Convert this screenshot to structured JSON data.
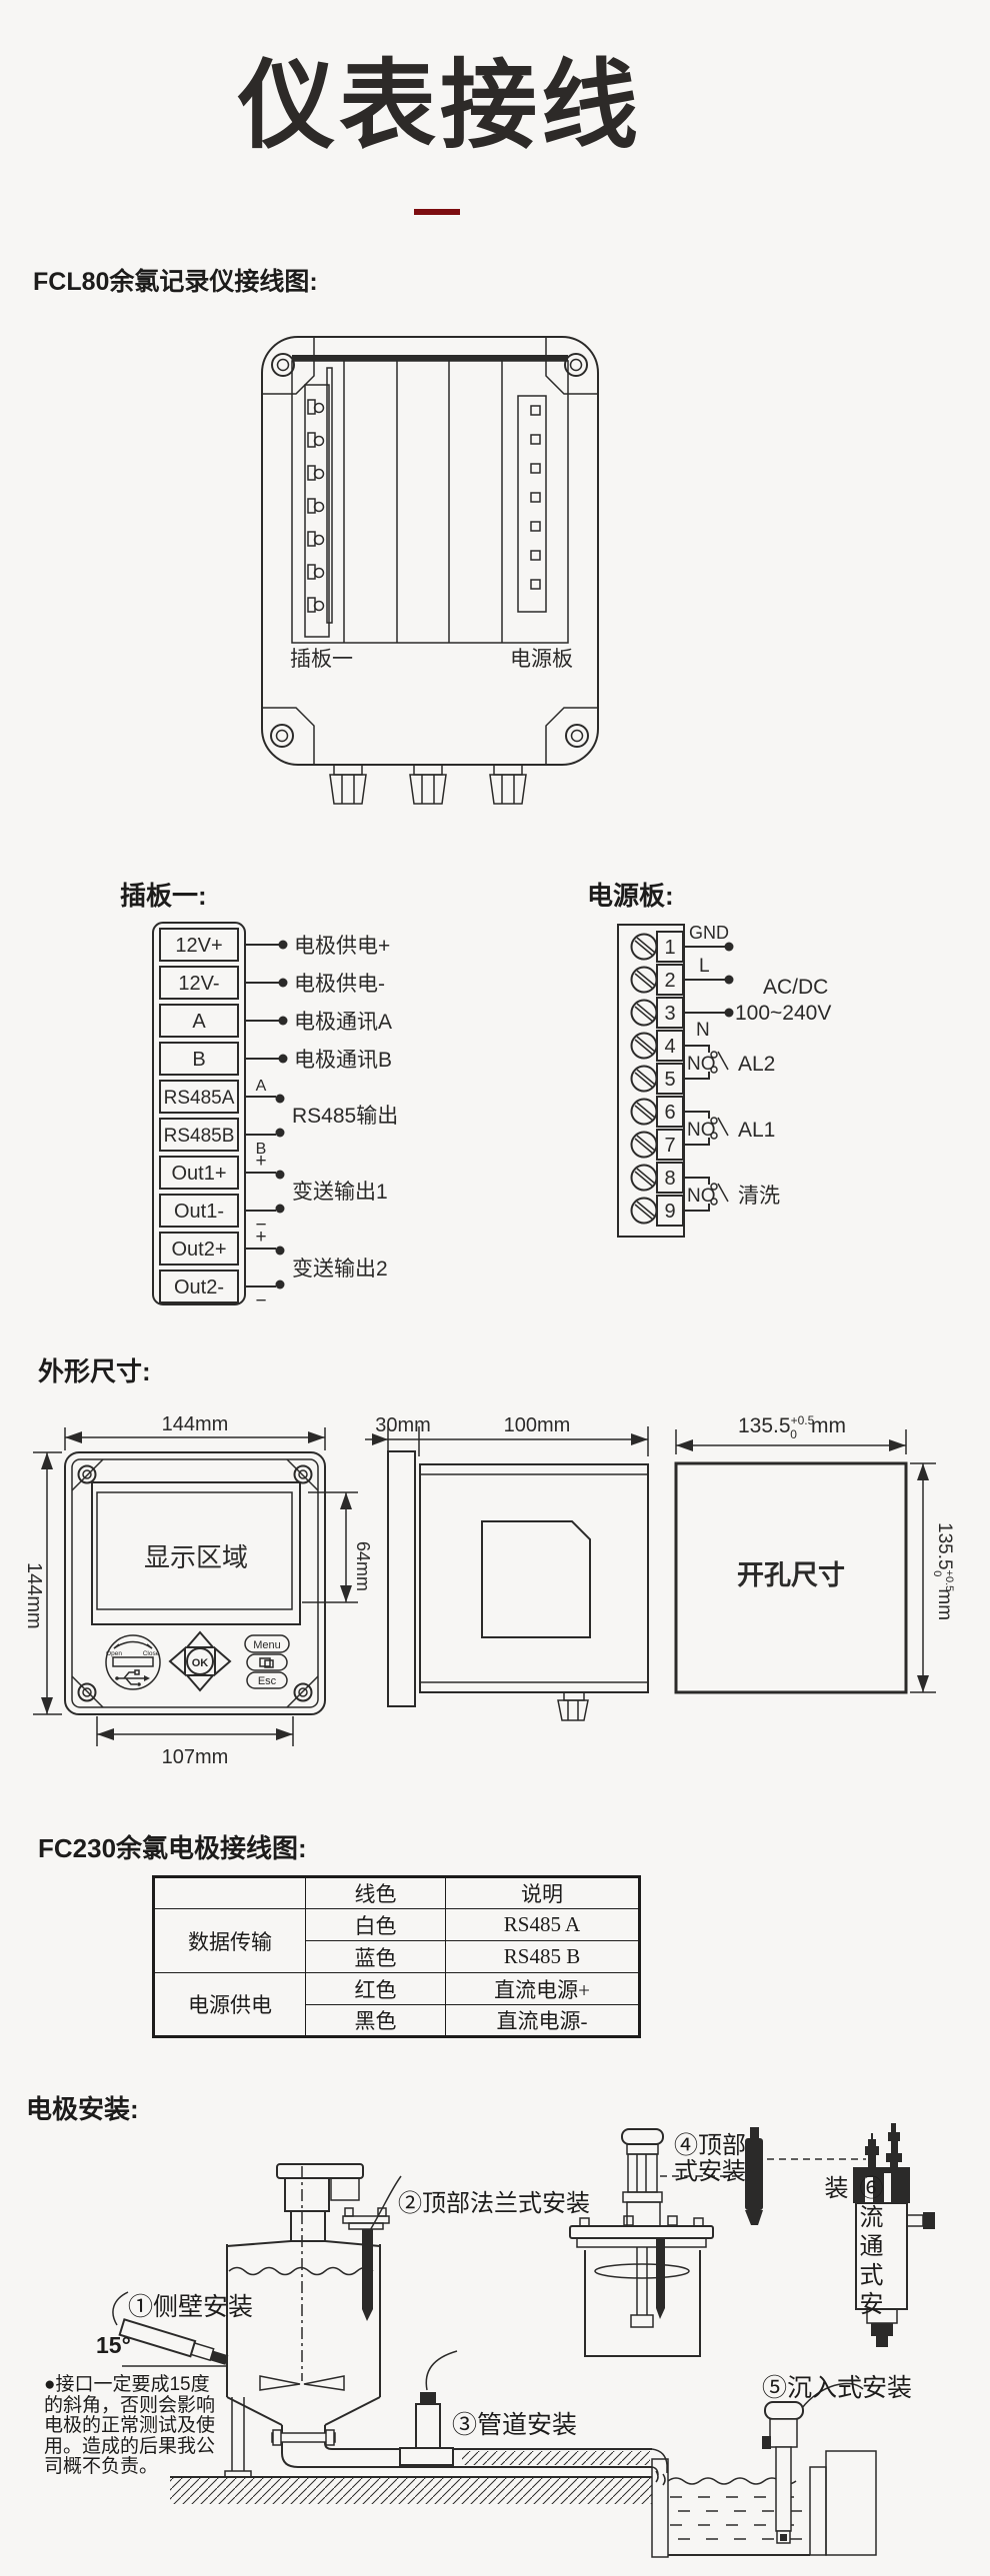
{
  "page": {
    "title": "仪表接线",
    "accent_color": "#7d0e11",
    "ink_color": "#2b2a29",
    "bg_color": "#f7f6f4"
  },
  "wiring": {
    "heading": "FCL80余氯记录仪接线图:",
    "device": {
      "board1": "插板一",
      "power": "电源板"
    },
    "board1": {
      "heading": "插板一:",
      "terminals": [
        "12V+",
        "12V-",
        "A",
        "B",
        "RS485A",
        "RS485B",
        "Out1+",
        "Out1-",
        "Out2+",
        "Out2-"
      ],
      "pin_notes": [
        "电极供电+",
        "电极供电-",
        "电极通讯A",
        "电极通讯B"
      ],
      "marks": {
        "a": "A",
        "b": "B",
        "p1": "+",
        "m1": "−",
        "p2": "+",
        "m2": "−"
      },
      "group_notes": [
        "RS485输出",
        "变送输出1",
        "变送输出2"
      ]
    },
    "power": {
      "heading": "电源板:",
      "terminals": [
        "1",
        "2",
        "3",
        "4",
        "5",
        "6",
        "7",
        "8",
        "9"
      ],
      "gnd": "GND",
      "l": "L",
      "n": "N",
      "ac1": "AC/DC",
      "ac2": "100~240V",
      "no1": "NO",
      "no2": "NO",
      "no3": "NO",
      "al2": "AL2",
      "al1": "AL1",
      "wash": "清洗"
    }
  },
  "dims": {
    "heading": "外形尺寸:",
    "front": {
      "top": "144mm",
      "left": "144mm",
      "display": "显示区域",
      "screen": "64mm",
      "bottom": "107mm",
      "usb_open": "Open",
      "usb_close": "Close",
      "ok": "OK",
      "menu": "Menu",
      "esc": "Esc"
    },
    "side": {
      "bezel": "30mm",
      "depth": "100mm"
    },
    "hole": {
      "label": "开孔尺寸",
      "dim": "135.5",
      "tol_up": "+0.5",
      "tol_dn": "0",
      "unit": "mm"
    }
  },
  "electrode_table": {
    "heading": "FC230余氯电极接线图:",
    "col_wire": "线色",
    "col_desc": "说明",
    "groups": [
      {
        "name": "数据传输",
        "rows": [
          {
            "wire": "白色",
            "desc": "RS485 A"
          },
          {
            "wire": "蓝色",
            "desc": "RS485 B"
          }
        ]
      },
      {
        "name": "电源供电",
        "rows": [
          {
            "wire": "红色",
            "desc": "直流电源+"
          },
          {
            "wire": "黑色",
            "desc": "直流电源-"
          }
        ]
      }
    ]
  },
  "install": {
    "heading": "电极安装:",
    "m1": "①侧壁安装",
    "m2": "②顶部法兰式安装",
    "m3": "③管道安装",
    "m4a": "④顶部",
    "m4b": "式安装",
    "m5": "⑤沉入式安装",
    "m6": "⑥流通式安装",
    "angle": "15°",
    "note": "●接口一定要成15度\n的斜角，否则会影响\n电极的正常测试及使\n用。造成的后果我公\n司概不负责。"
  }
}
